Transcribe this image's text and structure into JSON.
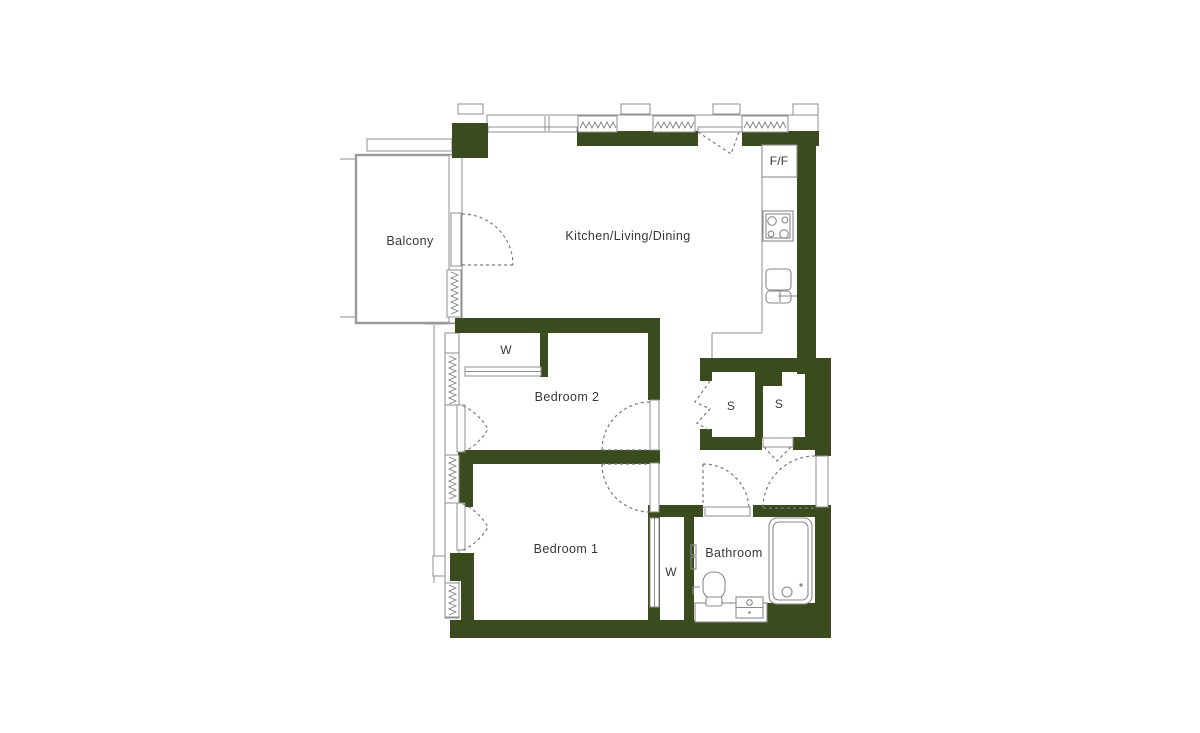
{
  "plan": {
    "type": "apartment-floorplan",
    "colors": {
      "wall": "#3a4c1e",
      "line": "#8f8f8f",
      "dash": "#7a7a7a",
      "text": "#383838",
      "bg": "#ffffff"
    },
    "labels": {
      "balcony": "Balcony",
      "kitchen": "Kitchen/Living/Dining",
      "bedroom2": "Bedroom 2",
      "bedroom1": "Bedroom 1",
      "bathroom": "Bathroom",
      "wardrobe_bedroom2": "W",
      "wardrobe_hall": "W",
      "store_left": "S",
      "store_right": "S",
      "fridge_freezer": "F/F"
    },
    "fixtures": [
      "fridge-freezer",
      "hob",
      "kitchen-sink",
      "bath",
      "toilet",
      "basin",
      "vanity-counter"
    ],
    "features": [
      "balcony-door",
      "bedroom2-door",
      "bedroom1-door",
      "bathroom-door",
      "entrance-door",
      "store-left-bifold-door",
      "store-right-door",
      "sliding-wardrobe-doors",
      "window-hatches-top",
      "window-hatches-left"
    ]
  }
}
